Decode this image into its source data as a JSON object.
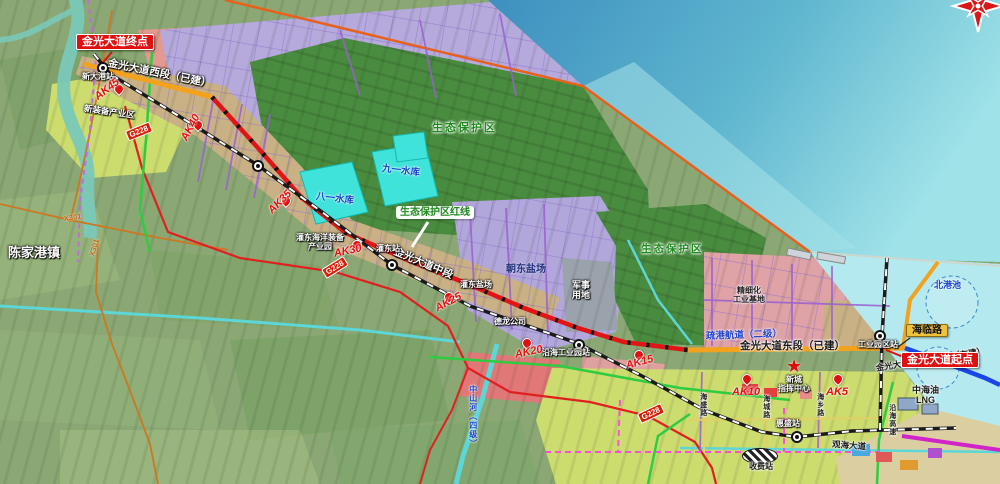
{
  "labels": {
    "jinguang_end": "金光大道终点",
    "jinguang_start": "金光大道起点",
    "road_west": "金光大道西段（已建）",
    "road_mid": "金光大道中段",
    "road_east": "金光大道东段（已建）",
    "road_conn": "金光大道港池连接线（在建）",
    "hailin": "海临路",
    "channel": "疏港航道（二级）",
    "ecoline": "生态保护区红线",
    "eco1": "生态保护区",
    "eco2": "生态保护区",
    "res81": "八一水库",
    "res91": "九一水库",
    "chenjiagang": "陈家港镇",
    "zone_xinzhuang": "新装备产业区",
    "zone_guandong1": "灌东海洋装备",
    "zone_guandong2": "产业园",
    "yc_chaodong": "朝东盐场",
    "yc_guandong": "灌东盐场",
    "junshi1": "军事",
    "junshi2": "用地",
    "delong": "德龙公司",
    "jingxi1": "精细化",
    "jingxi2": "工业基地",
    "xincheng1": "新城",
    "xincheng2": "指挥中心",
    "lng1": "中海油",
    "lng2": "LNG",
    "beigangchi": "北港池",
    "st_xindagang": "新大港站",
    "st_guandong": "灌东站",
    "st_yanhai": "沿海工业园站",
    "st_huisheng": "惠盛站",
    "st_gongyeyuan": "工业园区站",
    "canal_zs": "中山河（四级）",
    "rd_haisheng": "海盛路",
    "rd_haicheng": "海城路",
    "rd_haixiang": "海乡路",
    "guanhai": "观海大道",
    "shoufei": "收费站",
    "yanhai_gs": "沿海高速",
    "x301": "X301",
    "g228": "G228",
    "ak45": "AK45",
    "ak40": "AK40",
    "ak35": "AK35",
    "ak30": "AK30",
    "ak25": "AK25",
    "ak20": "AK20",
    "ak15": "AK15",
    "ak10": "AK10",
    "ak5": "AK5",
    "star_glyph": "★"
  },
  "icons": {
    "station": "circled-dot-station",
    "ak_marker": "red-milestone-pin",
    "compass": "compass-rose",
    "toll": "hatched-toll-ellipse"
  },
  "colors": {
    "built_road": "#f2a21d",
    "planned_road": "#e01515",
    "under_construction_road": "#1a46e8",
    "eco_zone": "#4a8c3f",
    "salt_field": "#b2a7da",
    "sea": "#4aa0c6",
    "reservoir": "#3fe3da",
    "eco_redline": "#e8611c",
    "label_red_box": "#e01010",
    "label_yellow_box": "#f0c23c"
  }
}
